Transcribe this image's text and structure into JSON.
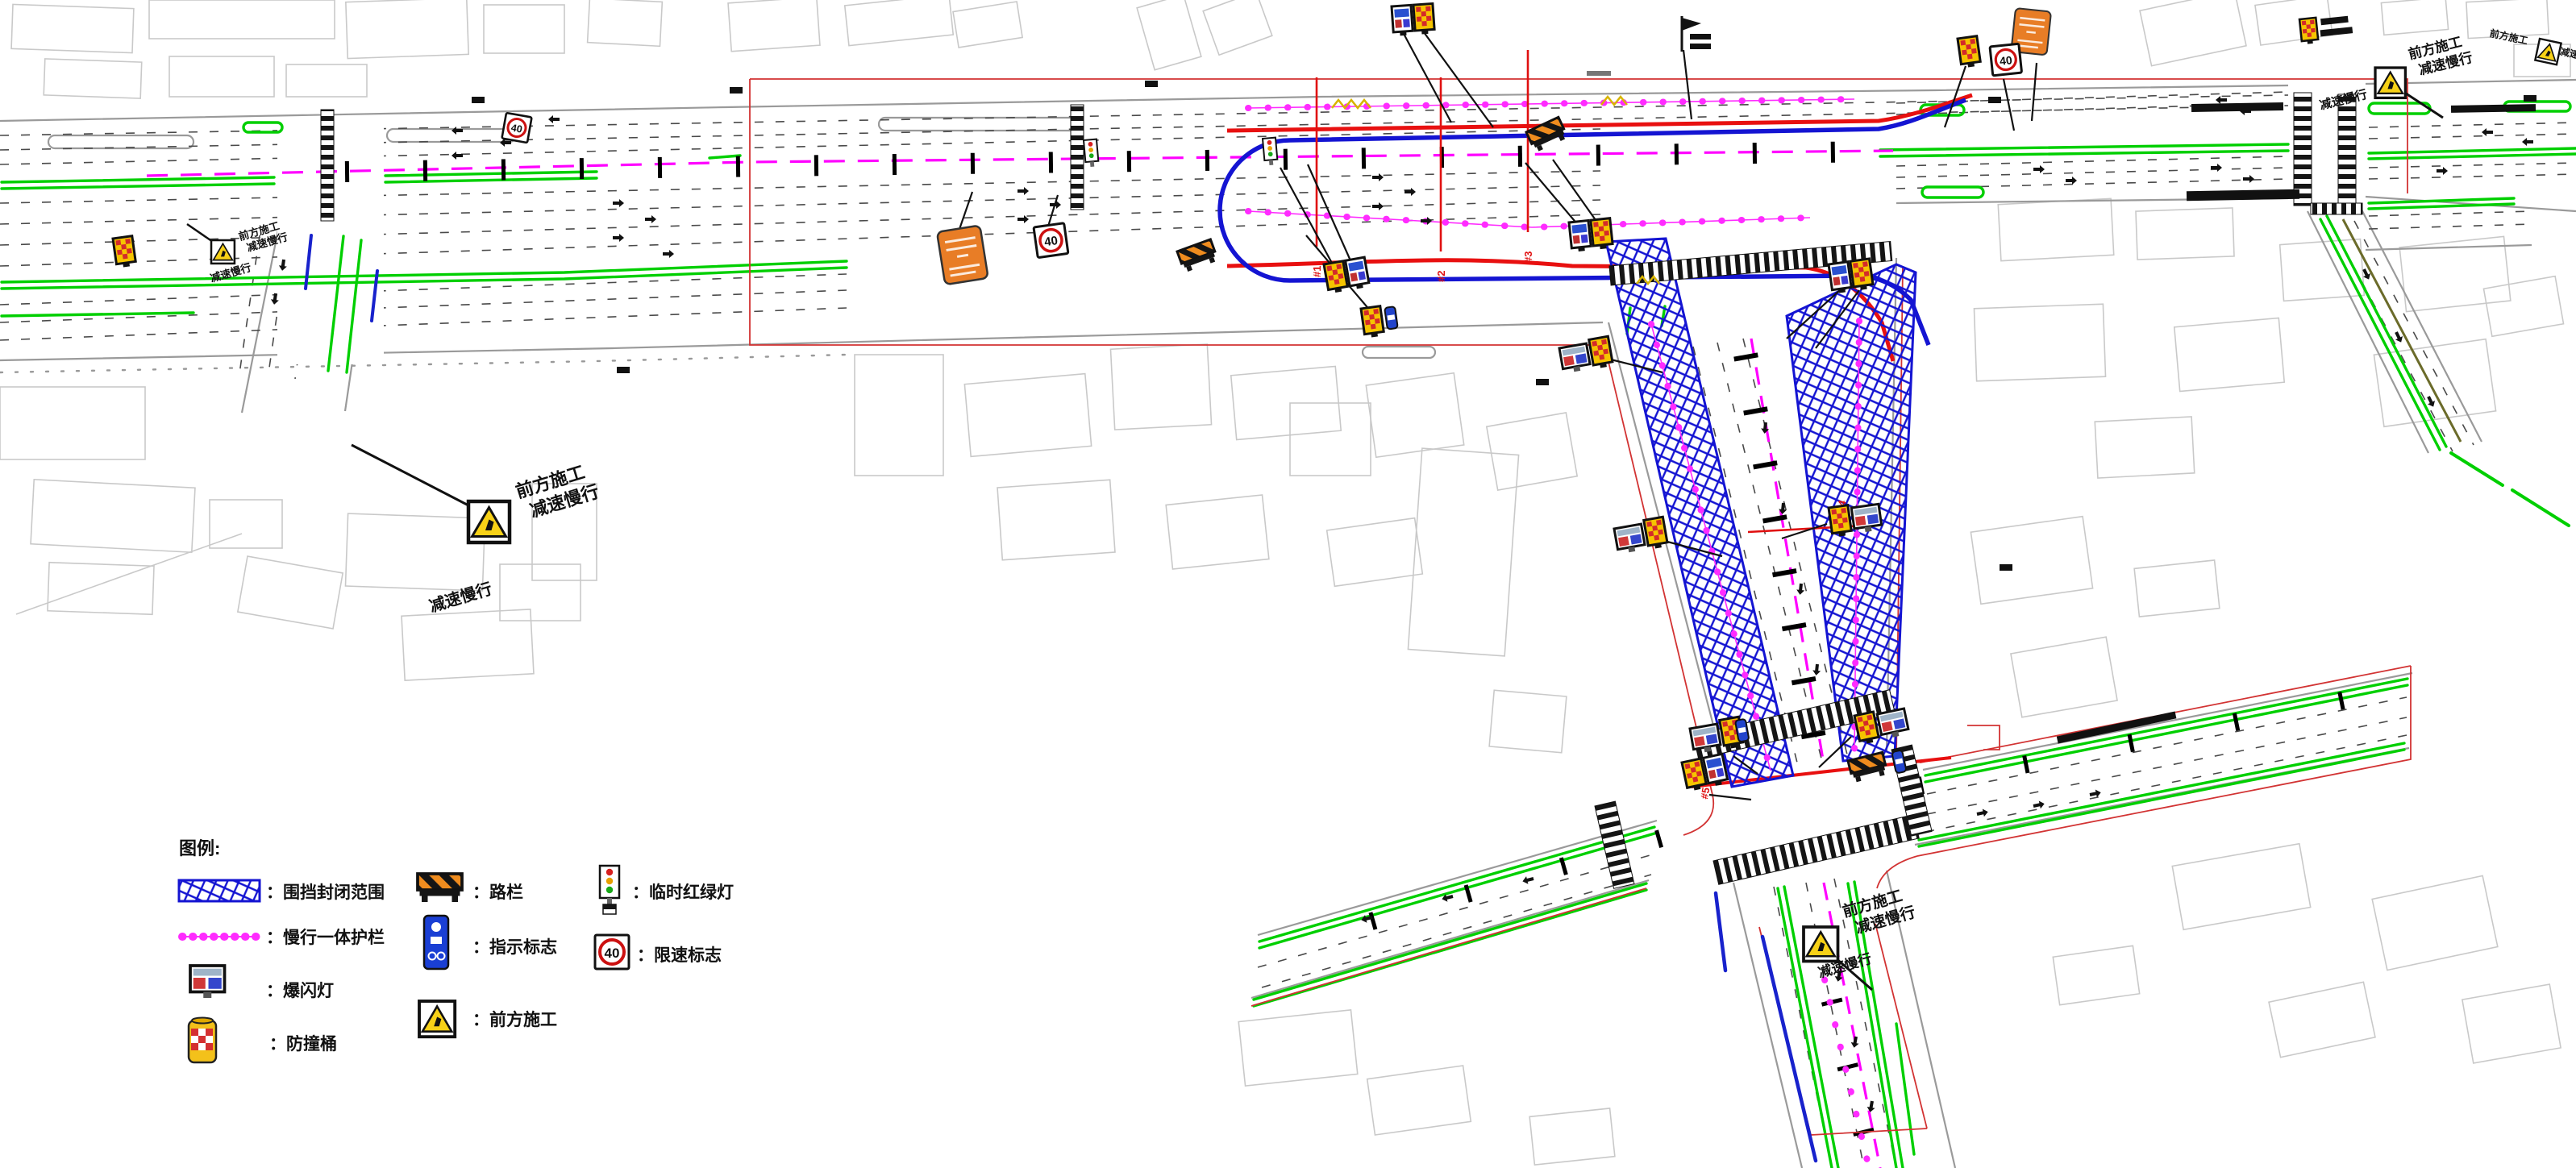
{
  "legend": {
    "title": "图例:",
    "colon": "：",
    "items": {
      "enclosure": "围挡封闭范围",
      "guardrail": "慢行一体护栏",
      "strobe": "爆闪灯",
      "barrel": "防撞桶",
      "barrier": "路栏",
      "guide": "指示标志",
      "construction": "前方施工",
      "signal": "临时红绿灯",
      "speed": "限速标志"
    }
  },
  "signs": {
    "speed_limit": "40"
  },
  "callout": {
    "line1": "前方施工",
    "line2": "减速慢行"
  },
  "markers": {
    "m1": "#1",
    "m2": "#2",
    "m3": "#3",
    "m4": "#4",
    "m5": "#5"
  }
}
